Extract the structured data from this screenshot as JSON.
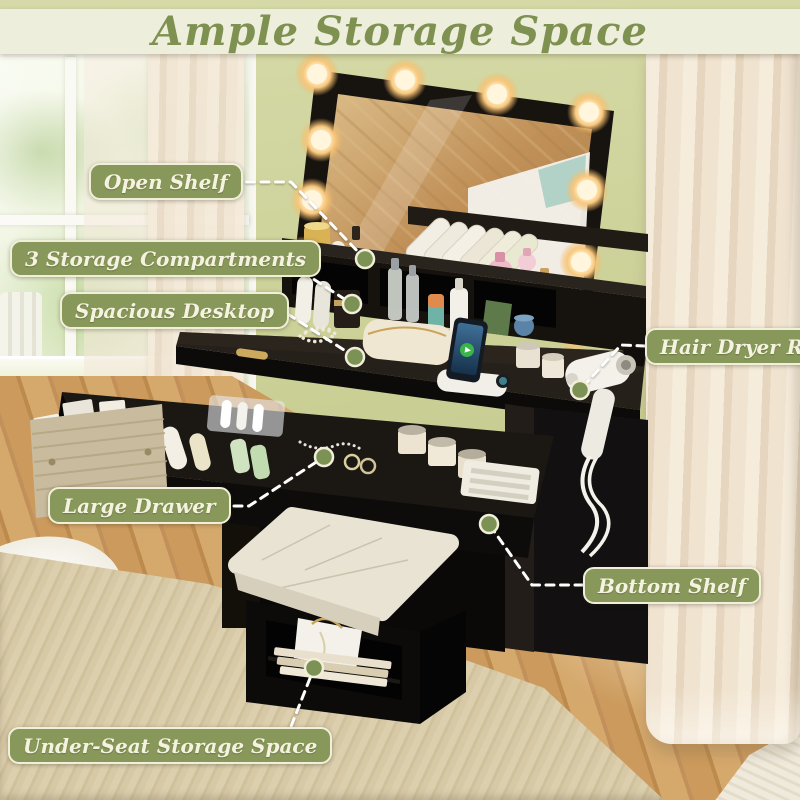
{
  "title": {
    "text": "Ample Storage Space"
  },
  "callouts": [
    {
      "id": "open-shelf",
      "label": "Open Shelf"
    },
    {
      "id": "storage-compartments",
      "label": "3 Storage Compartments"
    },
    {
      "id": "spacious-desktop",
      "label": "Spacious Desktop"
    },
    {
      "id": "hair-dryer-rack",
      "label": "Hair Dryer Rack"
    },
    {
      "id": "large-drawer",
      "label": "Large Drawer"
    },
    {
      "id": "bottom-shelf",
      "label": "Bottom Shelf"
    },
    {
      "id": "under-seat-storage",
      "label": "Under-Seat Storage Space"
    }
  ],
  "scene": {
    "book_spines": [
      "YOU",
      "LUXURY"
    ]
  },
  "colors": {
    "wall_green": "#cbd096",
    "banner_bg": "#eeeedd",
    "title_green": "#7e9150",
    "callout_bg": "#87985a",
    "callout_border": "#f1efda",
    "callout_text": "#f5f3e0",
    "connector": "#ffffff",
    "dot_fill": "#7c9154"
  }
}
